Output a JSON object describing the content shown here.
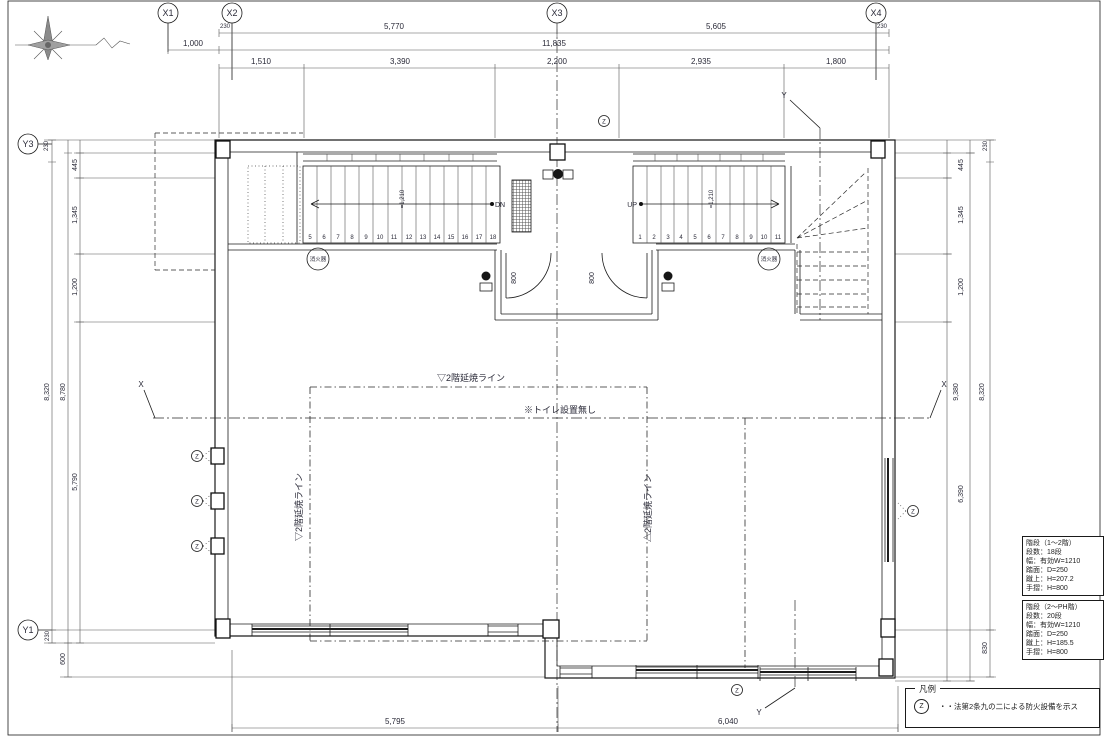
{
  "grid": {
    "x1": "X1",
    "x2": "X2",
    "x3": "X3",
    "x4": "X4",
    "y3": "Y3",
    "y1": "Y1"
  },
  "dims": {
    "top": {
      "a230l": "230",
      "a5770": "5,770",
      "a5605": "5,605",
      "a230r": "230",
      "b1000": "1,000",
      "b11835": "11,835",
      "c1510": "1,510",
      "c3390": "3,390",
      "c2200": "2,200",
      "c2935": "2,935",
      "c1800": "1,800"
    },
    "left": {
      "t230": "230",
      "v445": "445",
      "v1345": "1,345",
      "v1200": "1,200",
      "v8320": "8,320",
      "v8780": "8,780",
      "v5790": "5,790",
      "b230": "230",
      "b600": "600"
    },
    "right": {
      "t230": "230",
      "v445": "445",
      "v1345": "1,345",
      "v1200": "1,200",
      "v9380": "9,380",
      "v8320": "8,320",
      "v6390": "6,390",
      "b830": "830"
    },
    "bottom": {
      "d5795": "5,795",
      "d6040": "6,040"
    }
  },
  "stair_left": {
    "numbers": [
      "5",
      "6",
      "7",
      "8",
      "9",
      "10",
      "11",
      "12",
      "13",
      "14",
      "15",
      "16",
      "17",
      "18"
    ],
    "dn": "DN",
    "width": "=1,210"
  },
  "stair_right": {
    "numbers": [
      "1",
      "2",
      "3",
      "4",
      "5",
      "6",
      "7",
      "8",
      "9",
      "10",
      "11"
    ],
    "up": "UP",
    "width": "=1,210"
  },
  "doors": {
    "w1": "800",
    "w2": "800"
  },
  "marks": {
    "x": "X",
    "y": "Y",
    "z": "Z",
    "fire": "消火器"
  },
  "texts": {
    "ensho_top": "▽2階延焼ライン",
    "ensho_left": "▽2階延焼ライン",
    "ensho_right": "△2階延焼ライン",
    "no_toilet": "※トイレ設置無し"
  },
  "notes1": {
    "title": "階段（1〜2階）",
    "steps": "段数：18段",
    "width": "幅：有効W=1210",
    "tread": "踏面：D=250",
    "riser": "蹴上：H=207.2",
    "rail": "手摺：H=800"
  },
  "notes2": {
    "title": "階段（2〜PH階）",
    "steps": "段数：20段",
    "width": "幅：有効W=1210",
    "tread": "踏面：D=250",
    "riser": "蹴上：H=185.5",
    "rail": "手摺：H=800"
  },
  "legend": {
    "title": "凡例",
    "sym": "Z",
    "desc": "・・法第2条九の二による防火設備を示ス"
  }
}
